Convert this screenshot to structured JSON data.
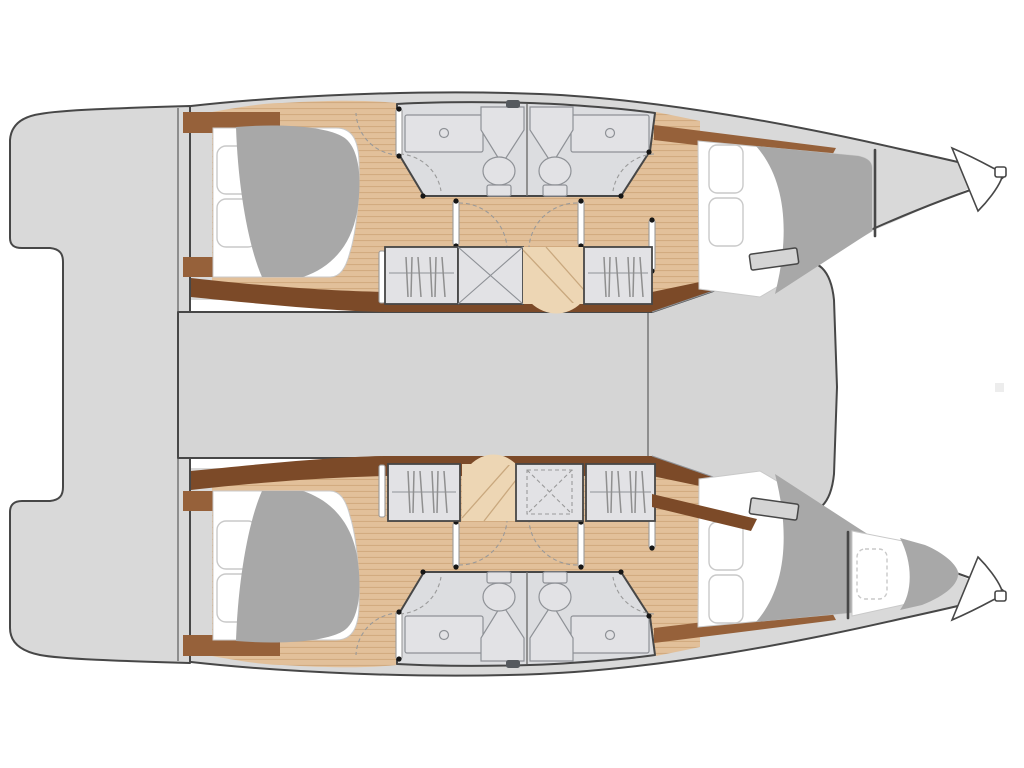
{
  "diagram": {
    "label": "Catamaran lower-deck floor plan, top-down view, bow to the right",
    "type": "boat-floor-plan",
    "vessel": "sailing catamaran",
    "layout_summary": "4 double cabins, 4 heads, forepeak berth in starboard hull",
    "hulls": [
      {
        "id": "port-hull",
        "position": "top",
        "rooms": [
          {
            "name": "aft-cabin",
            "furniture": [
              "double-berth",
              "two-pillows",
              "duvet",
              "headboard-shelves"
            ]
          },
          {
            "name": "aft-head",
            "fixtures": [
              "vanity-counter",
              "washbasin-faucet",
              "toilet",
              "shower-stall",
              "door-swing"
            ]
          },
          {
            "name": "forward-head",
            "fixtures": [
              "vanity-counter",
              "washbasin-faucet",
              "toilet",
              "shower-stall",
              "door-swing"
            ]
          },
          {
            "name": "companionway",
            "features": [
              "hanging-locker-aft",
              "storage-locker",
              "entry-steps",
              "hanging-locker-forward"
            ]
          },
          {
            "name": "forward-cabin",
            "furniture": [
              "double-berth",
              "two-pillows",
              "duvet"
            ]
          },
          {
            "name": "bow-locker",
            "furniture": []
          }
        ]
      },
      {
        "id": "starboard-hull",
        "position": "bottom",
        "rooms": [
          {
            "name": "aft-cabin",
            "furniture": [
              "double-berth",
              "two-pillows",
              "duvet",
              "headboard-shelves"
            ]
          },
          {
            "name": "aft-head",
            "fixtures": [
              "vanity-counter",
              "washbasin-faucet",
              "toilet",
              "shower-stall",
              "door-swing"
            ]
          },
          {
            "name": "forward-head",
            "fixtures": [
              "vanity-counter",
              "washbasin-faucet",
              "toilet",
              "shower-stall",
              "door-swing"
            ]
          },
          {
            "name": "companionway",
            "features": [
              "hanging-locker-aft",
              "entry-steps",
              "storage-locker-dashed",
              "hanging-locker-forward"
            ]
          },
          {
            "name": "forward-cabin",
            "furniture": [
              "double-berth",
              "two-pillows",
              "duvet"
            ]
          },
          {
            "name": "forepeak-berth",
            "furniture": [
              "single-berth",
              "pillow-dashed",
              "duvet"
            ]
          }
        ]
      }
    ],
    "deck_areas": [
      "aft-platform",
      "aft-steps",
      "cockpit-band",
      "bridgedeck",
      "foredeck-point",
      "deck-hatch-port",
      "deck-hatch-starboard"
    ]
  },
  "colors": {
    "outline": "#474747",
    "thin": "#6f6f6f",
    "deck": "#d9d9d9",
    "bridge": "#d5d5d5",
    "bath": "#dcdde0",
    "fixture": "#e2e2e5",
    "fixtureLine": "#8e9196",
    "wood": "#e2c09a",
    "woodLine": "#d2ab80",
    "woodLight": "#edd6b4",
    "brown": "#96613a",
    "brownDark": "#7c4a28",
    "duvet": "#a8a8a8",
    "pillowLine": "#c9c9c9",
    "dashLine": "#9a9a9a",
    "dot": "#161616",
    "hatch": "#d4d4d4",
    "tick": "#55595e"
  }
}
